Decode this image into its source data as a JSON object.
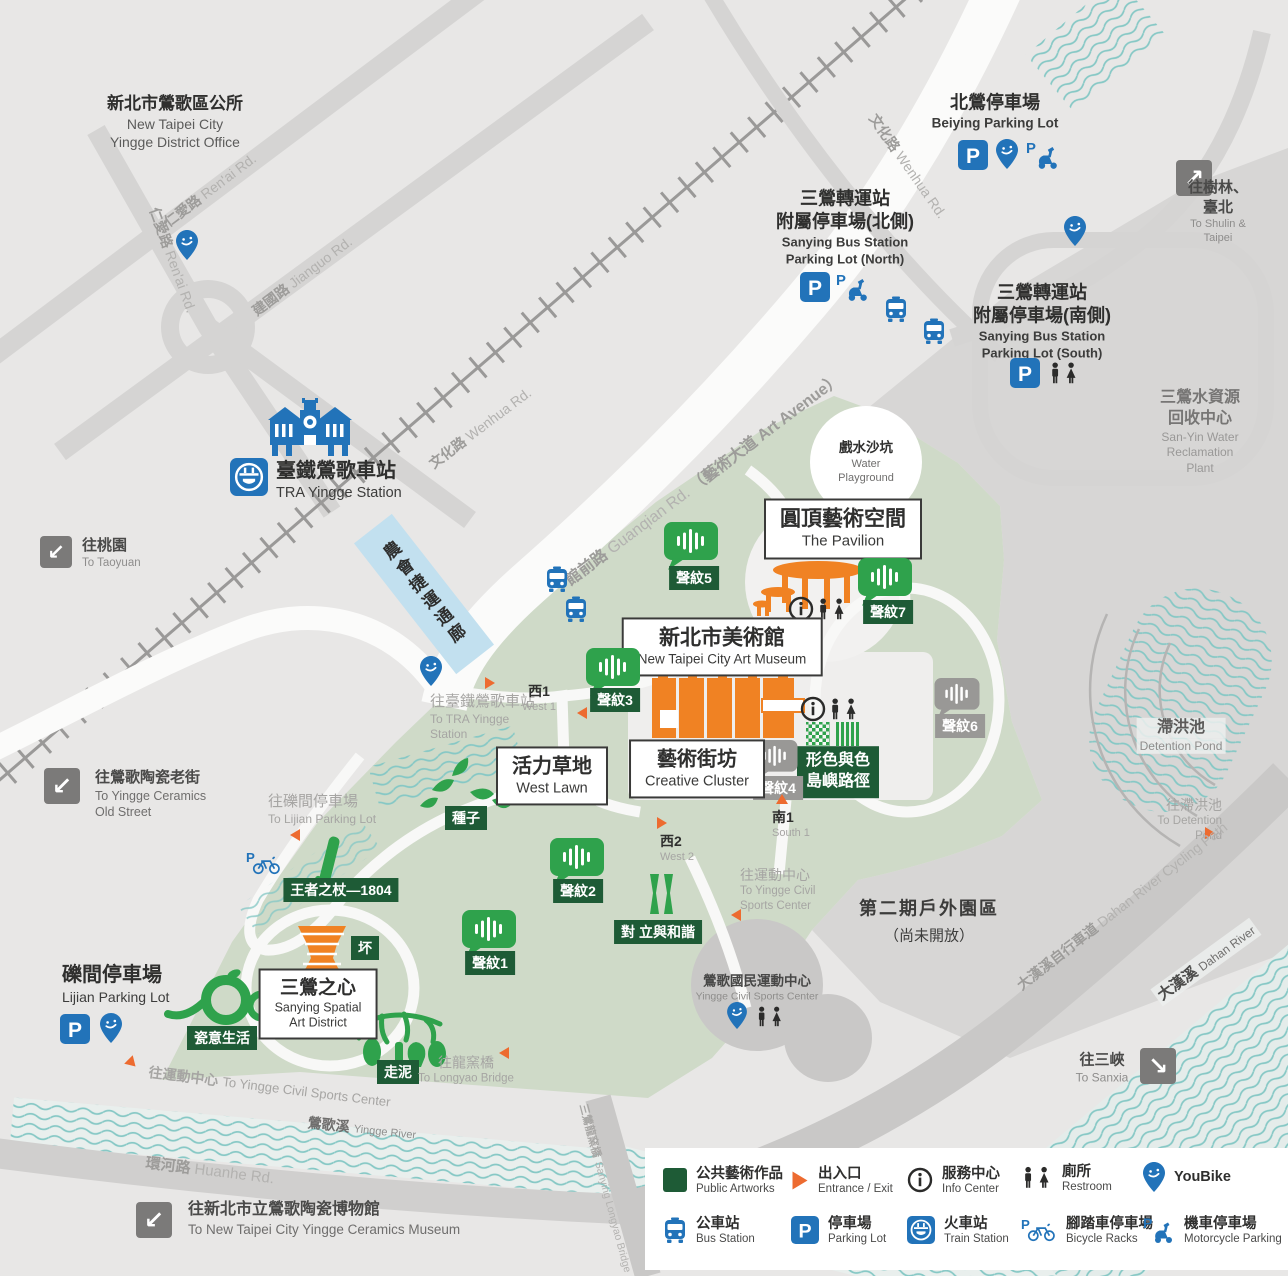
{
  "places": {
    "district_office": {
      "zh": "新北市鶯歌區公所",
      "en1": "New Taipei City",
      "en2": "Yingge District Office"
    },
    "beiying": {
      "zh": "北鶯停車場",
      "en": "Beiying Parking Lot"
    },
    "sanying_north": {
      "zh1": "三鶯轉運站",
      "zh2": "附屬停車場(北側)",
      "en1": "Sanying Bus Station",
      "en2": "Parking Lot (North)"
    },
    "sanying_south": {
      "zh1": "三鶯轉運站",
      "zh2": "附屬停車場(南側)",
      "en1": "Sanying Bus Station",
      "en2": "Parking Lot (South)"
    },
    "shulin": {
      "zh": "往樹林、臺北",
      "en": "To Shulin & Taipei"
    },
    "reclamation": {
      "zh1": "三鶯水資源",
      "zh2": "回收中心",
      "en1": "San-Yin Water",
      "en2": "Reclamation Plant"
    },
    "tra": {
      "zh": "臺鐵鶯歌車站",
      "en": "TRA Yingge Station"
    },
    "corridor": {
      "zh": "農會捷運通廊"
    },
    "taoyuan": {
      "zh": "往桃園",
      "en": "To Taoyuan"
    },
    "water_playground": {
      "zh": "戲水沙坑",
      "en1": "Water",
      "en2": "Playground"
    },
    "pavilion": {
      "zh": "圓頂藝術空間",
      "en": "The Pavilion"
    },
    "museum": {
      "zh": "新北市美術館",
      "en": "New Taipei City Art Museum"
    },
    "creative": {
      "zh": "藝術街坊",
      "en": "Creative Cluster"
    },
    "west_lawn": {
      "zh": "活力草地",
      "en": "West Lawn"
    },
    "heart": {
      "zh": "三鶯之心",
      "en1": "Sanying Spatial",
      "en2": "Art District"
    },
    "island_path": {
      "zh1": "形色與色",
      "zh2": "島嶼路徑"
    },
    "phase2": {
      "zh": "第二期戶外園區",
      "note": "（尚未開放）"
    },
    "sports_center": {
      "zh": "鶯歌國民運動中心",
      "en": "Yingge Civil Sports Center"
    },
    "detention": {
      "zh": "滯洪池",
      "en": "Detention Pond"
    },
    "lijian": {
      "zh": "礫間停車場",
      "en": "Lijian Parking Lot"
    },
    "old_street": {
      "zh": "往鶯歌陶瓷老街",
      "en1": "To Yingge Ceramics",
      "en2": "Old Street"
    },
    "ceramics_museum": {
      "zh": "往新北市立鶯歌陶瓷博物館",
      "en": "To New Taipei City Yingge Ceramics Museum"
    },
    "sanxia": {
      "zh": "往三峽",
      "en": "To Sanxia"
    },
    "to_tra": {
      "zh": "往臺鐵鶯歌車站",
      "en1": "To TRA Yingge",
      "en2": "Station"
    },
    "to_lijian": {
      "zh": "往礫間停車場",
      "en": "To Lijian Parking Lot"
    },
    "to_sports_b": {
      "zh": "往運動中心",
      "en": "To Yingge Civil Sports Center"
    },
    "to_sports_r": {
      "zh": "往運動中心",
      "en1": "To Yingge Civil",
      "en2": "Sports Center"
    },
    "to_longyao": {
      "zh": "往龍窯橋",
      "en": "To Longyao Bridge"
    },
    "to_detention": {
      "zh": "往滯洪池",
      "en": "To Detention Pond"
    }
  },
  "artworks": {
    "seed": "種子",
    "scepter": "王者之杖—1804",
    "pei": "坏",
    "porcelain": "瓷意生活",
    "mud": "走泥",
    "harmony": "對 立與和諧"
  },
  "soundwaves": {
    "s1": "聲紋1",
    "s2": "聲紋2",
    "s3": "聲紋3",
    "s4": "聲紋4",
    "s5": "聲紋5",
    "s6": "聲紋6",
    "s7": "聲紋7"
  },
  "entrances": {
    "w1z": "西1",
    "w1e": "West 1",
    "w2z": "西2",
    "w2e": "West 2",
    "s1z": "南1",
    "s1e": "South 1"
  },
  "roads": {
    "renai_zh": "仁愛路",
    "renai_en": "Ren'ai Rd.",
    "jianguo_zh": "建國路",
    "jianguo_en": "Jianguo Rd.",
    "wenhua_zh": "文化路",
    "wenhua_en": "Wenhua Rd.",
    "guanqian_zh": "館前路",
    "guanqian_en": "Guanqian Rd.",
    "guanqian_extra": "（藝術大道 Art Avenue）",
    "huanhe_zh": "環河路",
    "huanhe_en": "Huanhe Rd.",
    "longyao_zh": "三鶯龍窯橋",
    "longyao_en": "Sanying Longyao Bridge",
    "cycling_zh": "大漢溪自行車道",
    "cycling_en": "Dahan River Cycling Path",
    "yingge_zh": "鶯歌溪",
    "yingge_en": "Yingge River",
    "dahan_zh": "大漢溪",
    "dahan_en": "Dahan River"
  },
  "legend": {
    "items": [
      {
        "zh": "公共藝術作品",
        "en": "Public Artworks"
      },
      {
        "zh": "出入口",
        "en": "Entrance / Exit"
      },
      {
        "zh": "服務中心",
        "en": "Info Center"
      },
      {
        "zh": "廁所",
        "en": "Restroom"
      },
      {
        "zh": "YouBike",
        "en": ""
      },
      {
        "zh": "公車站",
        "en": "Bus Station"
      },
      {
        "zh": "停車場",
        "en": "Parking Lot"
      },
      {
        "zh": "火車站",
        "en": "Train Station"
      },
      {
        "zh": "腳踏車停車場",
        "en": "Bicycle Racks"
      },
      {
        "zh": "機車停車場",
        "en": "Motorcycle Parking"
      }
    ]
  },
  "colors": {
    "park": "#cfdac8",
    "road_gray": "#d5d4d3",
    "blue": "#2273b9",
    "orange": "#f08223",
    "entrance_orange": "#ed6b30",
    "green": "#2fa24c",
    "dark_green": "#1e5b36",
    "corridor_blue": "#c2e0ef",
    "wave_teal": "#86c8c5",
    "bg": "#e8e7e6"
  }
}
